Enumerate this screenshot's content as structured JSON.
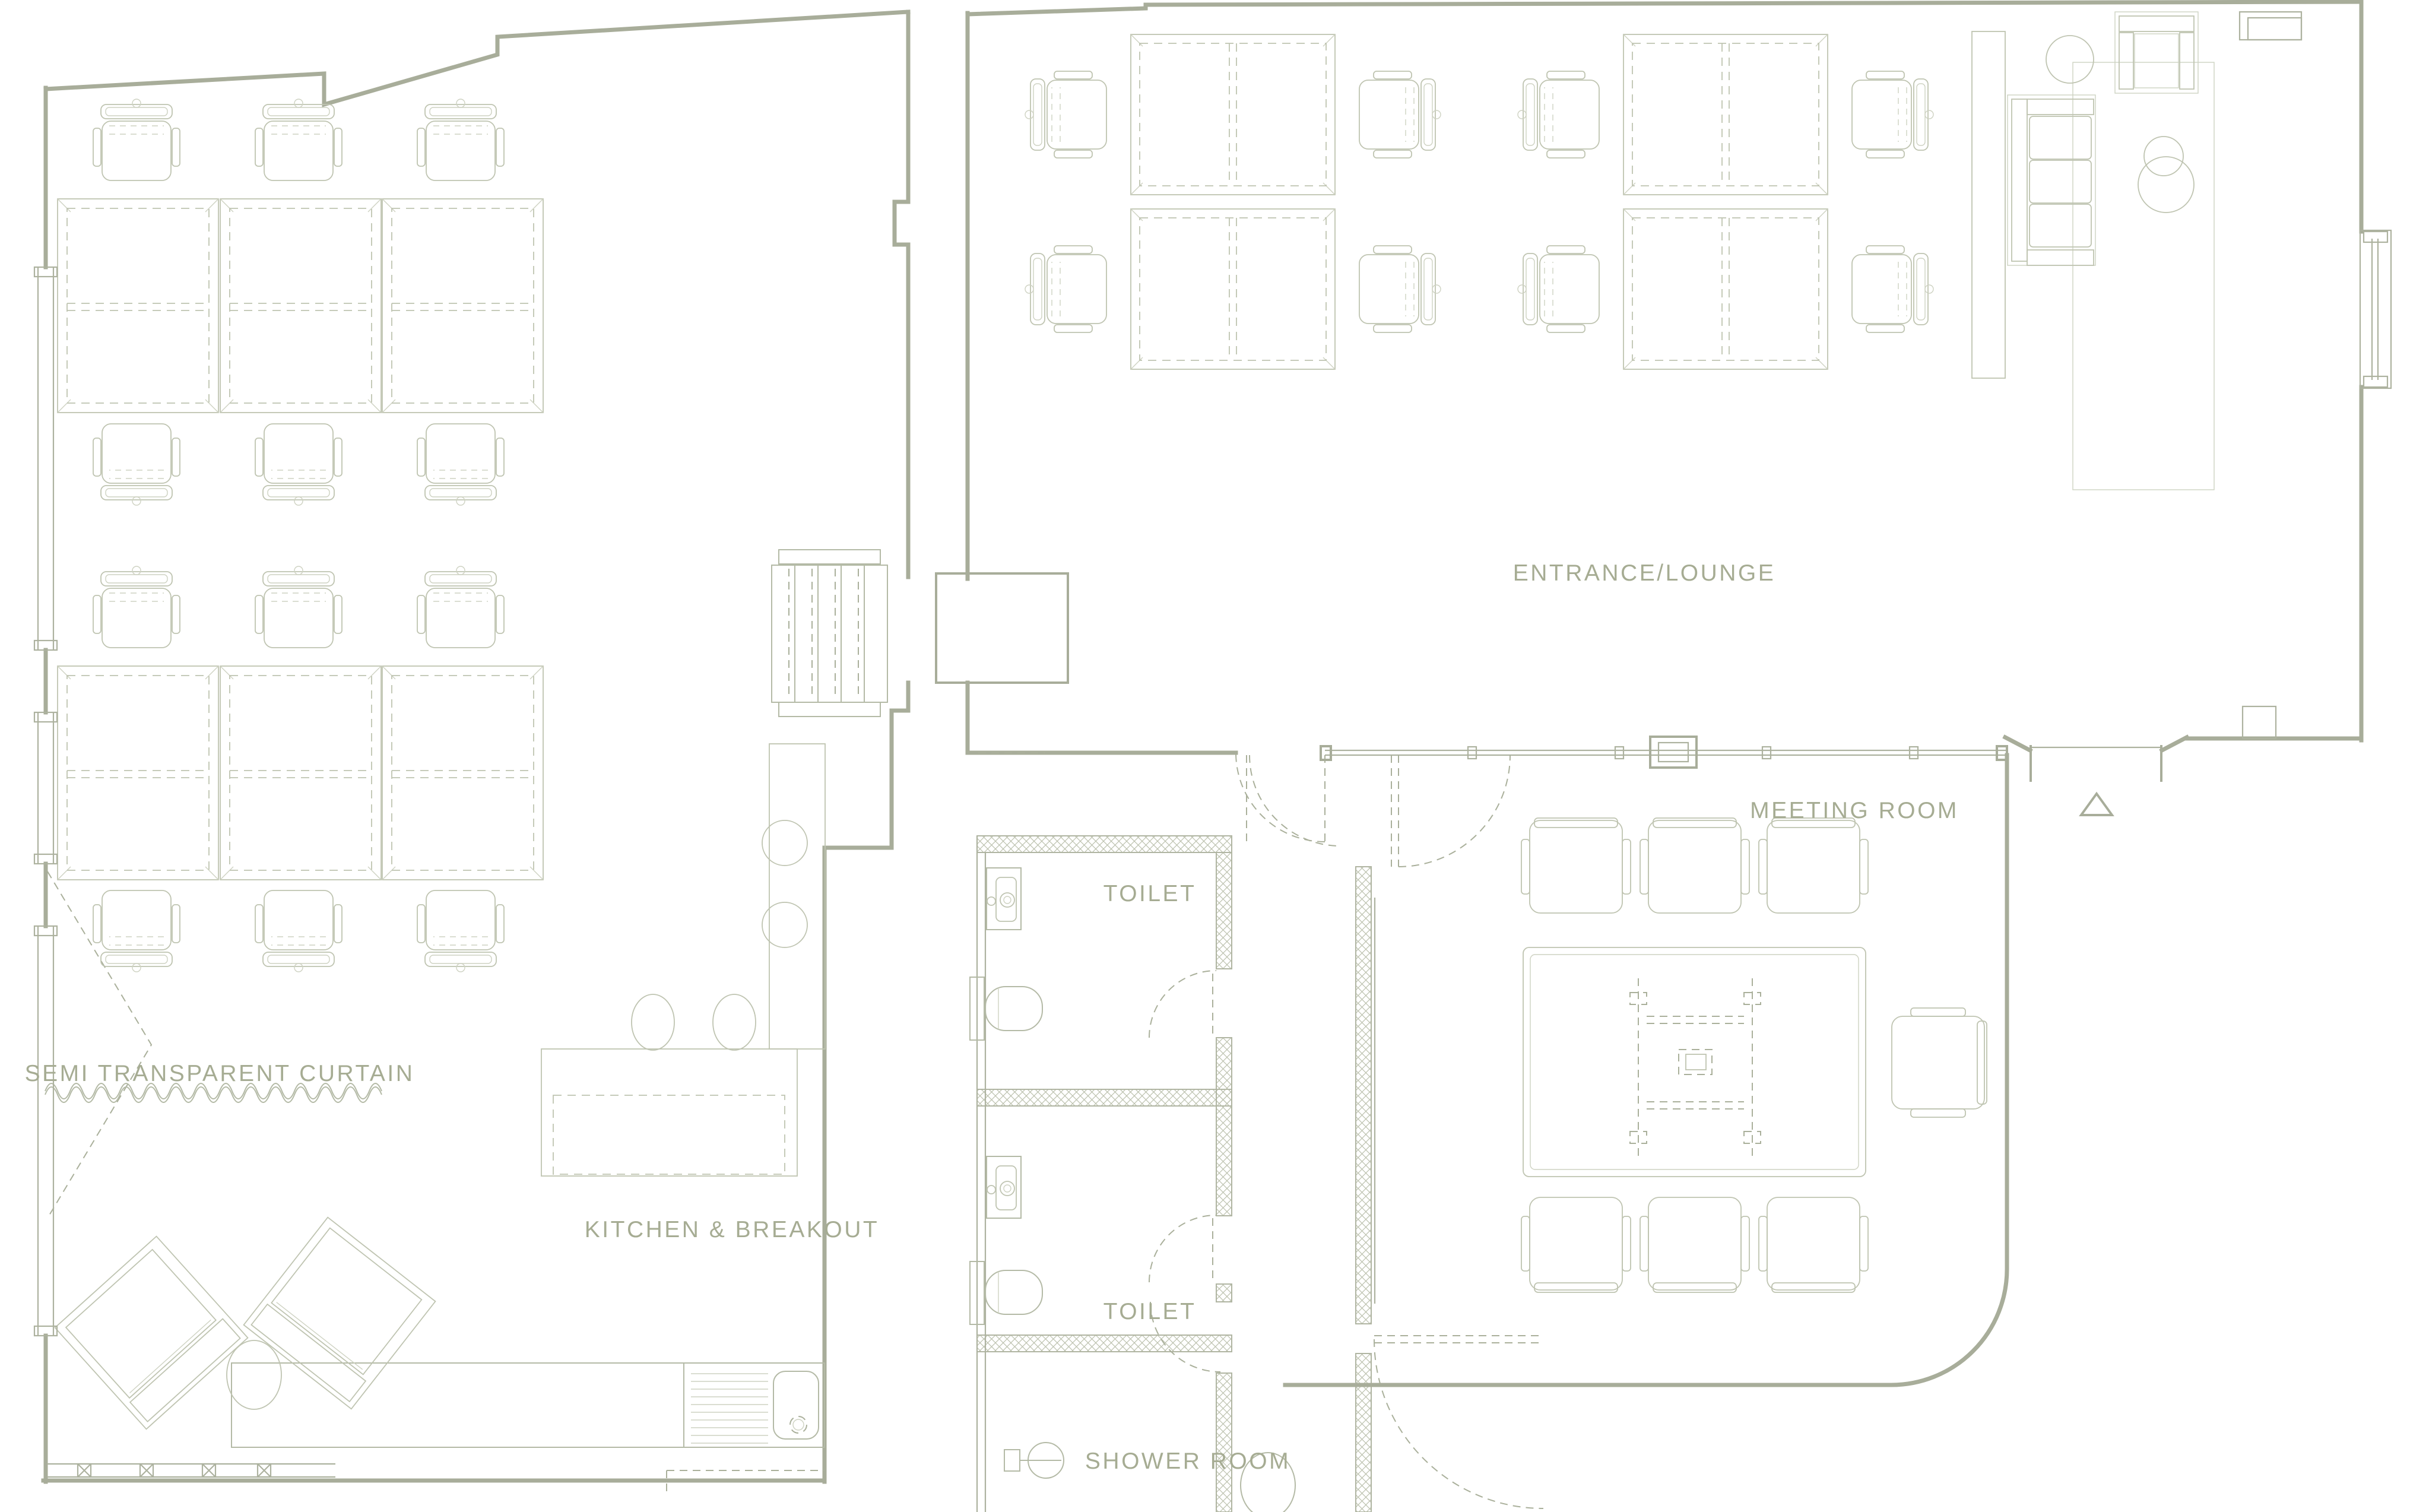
{
  "title": "Office floor plan",
  "colors": {
    "background": "#ffffff",
    "wall": "#a8ad9a",
    "furniture": "#bfc4b1",
    "label_text": "#a6ac93"
  },
  "labels": {
    "curtain": "SEMI TRANSPARENT CURTAIN",
    "kitchen": "KITCHEN & BREAKOUT",
    "toilet_upper": "TOILET",
    "toilet_lower": "TOILET",
    "shower": "SHOWER ROOM",
    "entrance_lounge": "ENTRANCE/LOUNGE",
    "meeting_room": "MEETING ROOM"
  }
}
